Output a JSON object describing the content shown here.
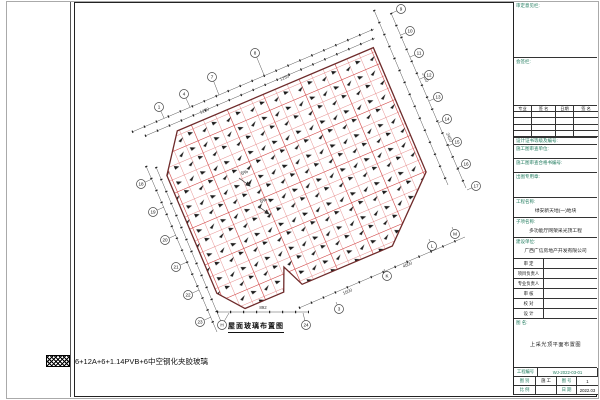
{
  "plan": {
    "caption": "屋面玻璃布置图",
    "legend_label": "6+12A+6+1.14PVB+6中空钢化夹胶玻璃",
    "slope_note": "5%",
    "bubbles": {
      "top": [
        "1",
        "4",
        "7",
        "8"
      ],
      "right": [
        "9",
        "10",
        "11",
        "12",
        "13",
        "14",
        "15",
        "16",
        "17"
      ],
      "left": [
        "18",
        "19",
        "20",
        "21",
        "22",
        "23"
      ],
      "bottom": [
        "H",
        "24"
      ],
      "chamfer": [
        "3",
        "K",
        "L",
        "M"
      ]
    },
    "dims": [
      "1250",
      "1250",
      "2450",
      "2450",
      "892",
      "4500",
      "1500"
    ]
  },
  "title_block": {
    "sec_approval": "审定意见栏:",
    "sec_signoff": "会签栏:",
    "sign_headers": [
      "专业",
      "签 名",
      "日期",
      "签 名"
    ],
    "cert_line": "设计证书等级及编号:",
    "review_unit": "施工图审查单位:",
    "review_cert": "施工图审查合格书编号:",
    "seal": "出图专用章:",
    "project_label": "工程名称:",
    "project_value": "绿安新天地(一)地块",
    "subitem_label": "子项名称:",
    "subitem_value": "多功能厅网架采光顶工程",
    "owner_label": "建设单位:",
    "owner_value": "广西广信房地产开发有限公司",
    "roles": [
      "审 定",
      "项目负责人",
      "专业负责人",
      "审 核",
      "校 对",
      "设 计"
    ],
    "figname_label": "图 名:",
    "figname_value": "上采光顶平面布置图",
    "projno_label": "工程编号",
    "projno_value": "WJ-2022-03-01",
    "figtype_label": "图 别",
    "figtype_value": "施 工",
    "figno_label": "图 号",
    "figno_value": "1",
    "scale_label": "比 例",
    "scale_value": "",
    "date_label": "日 期",
    "date_value": "2022.03"
  },
  "colors": {
    "grid_red": "#e06a6a",
    "grid_red_major": "#d14b4b",
    "outline_maroon": "#6e2a2a",
    "accent_green": "#1e7a5c"
  }
}
